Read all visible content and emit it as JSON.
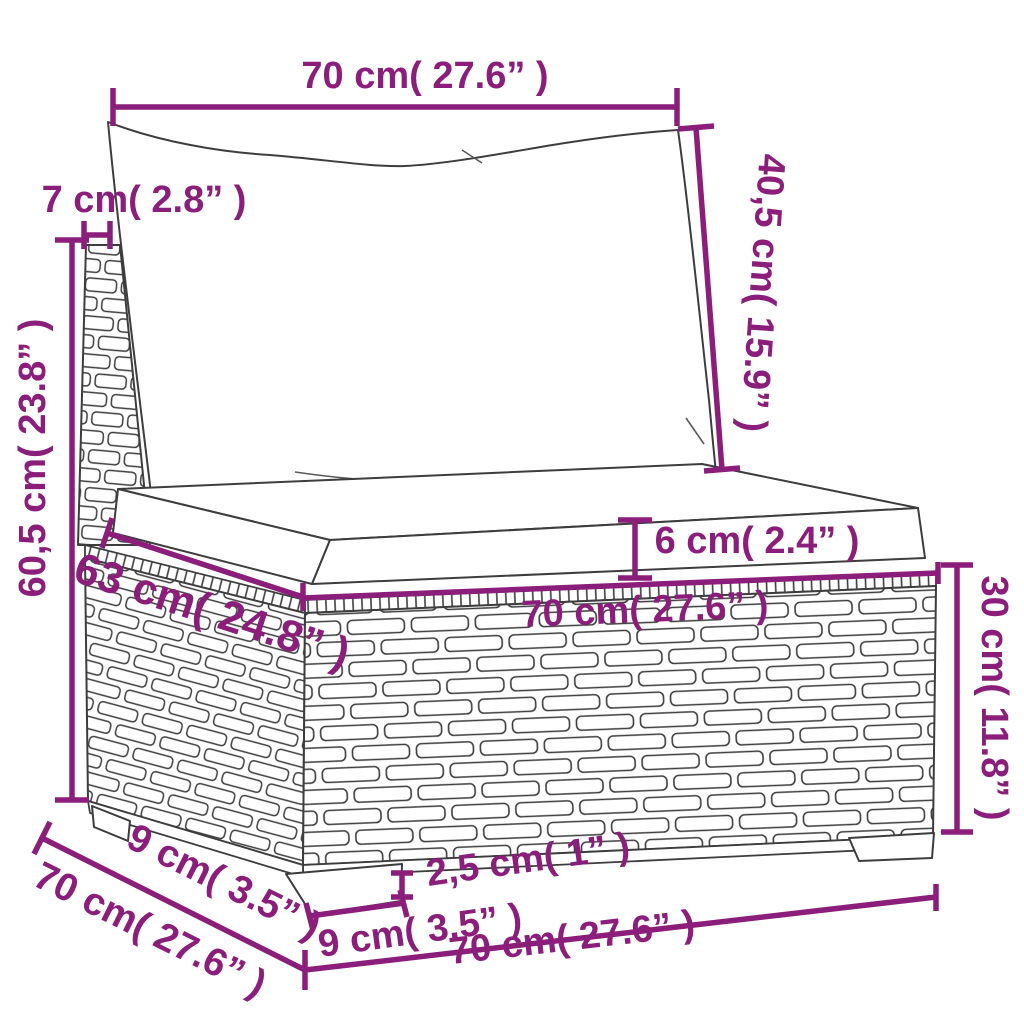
{
  "diagram": {
    "type": "product-dimension-diagram",
    "subject": "poly rattan garden sofa middle section with back pillow and seat cushion",
    "colors": {
      "dimension_accent": "#8B1E7A",
      "line_art": "#3d3d3d",
      "background": "#ffffff"
    },
    "dimensions": [
      {
        "name": "back-cushion-width",
        "label": "70 cm( 27.6” )"
      },
      {
        "name": "back-cushion-height",
        "label": "40,5 cm( 15.9” )"
      },
      {
        "name": "back-frame-depth",
        "label": "7 cm( 2.8” )"
      },
      {
        "name": "total-height",
        "label": "60,5 cm( 23.8” )"
      },
      {
        "name": "seat-cushion-thickness",
        "label": "6 cm( 2.4” )"
      },
      {
        "name": "seat-depth",
        "label": "63 cm( 24.8” )"
      },
      {
        "name": "seat-width",
        "label": "70 cm( 27.6” )"
      },
      {
        "name": "base-height",
        "label": "30 cm( 11.8” )"
      },
      {
        "name": "leg-inset-depth",
        "label": "9 cm( 3.5” )"
      },
      {
        "name": "total-depth",
        "label": "70 cm( 27.6” )"
      },
      {
        "name": "leg-height",
        "label": "2,5 cm( 1” )"
      },
      {
        "name": "leg-width",
        "label": "9 cm( 3.5” )"
      },
      {
        "name": "total-width",
        "label": "70 cm( 27.6” )"
      }
    ]
  }
}
